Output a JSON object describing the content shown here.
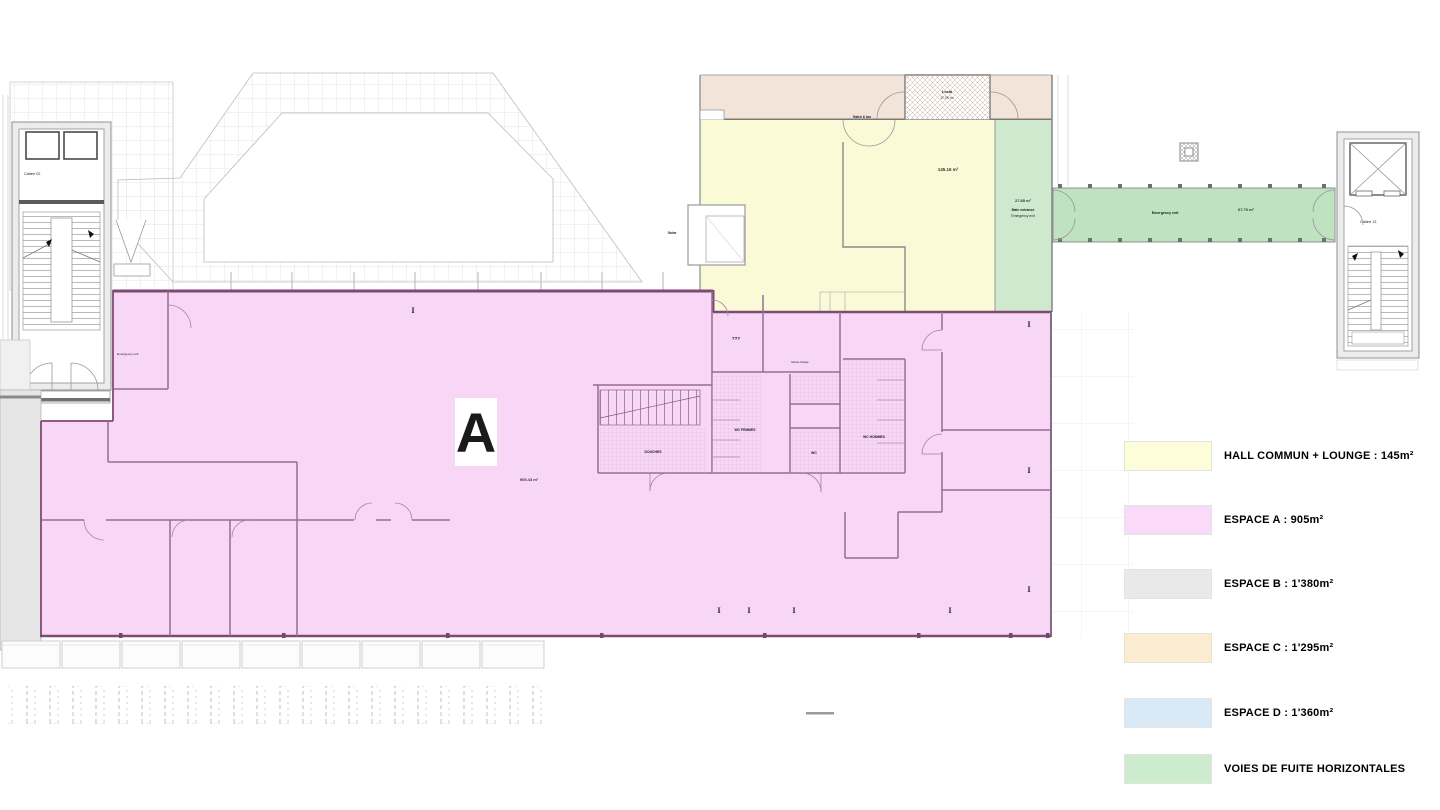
{
  "legend": {
    "items": [
      {
        "label": "HALL COMMUN + LOUNGE : 145m²",
        "color": "#fdfdda"
      },
      {
        "label": "ESPACE A : 905m²",
        "color": "#fbd9f8"
      },
      {
        "label": "ESPACE B : 1'380m²",
        "color": "#e9e9e9"
      },
      {
        "label": "ESPACE C : 1'295m²",
        "color": "#fcecd2"
      },
      {
        "label": "ESPACE D : 1'360m²",
        "color": "#d9eaf6"
      },
      {
        "label": "VOIES DE FUITE HORIZONTALES",
        "color": "#cdeccd"
      }
    ]
  },
  "plan": {
    "espace_a": {
      "big_label": "A",
      "area": "905.43 m²",
      "emergency_exit": "Emergency exit"
    },
    "hall": {
      "area": "145.16 m²",
      "hatch_label": "Hatch & bar"
    },
    "entrance": {
      "area": "27.85 m²",
      "line1": "Main entrance",
      "line2": "Emergency exit"
    },
    "corridor": {
      "label": "Emergency exit",
      "area": "67.70 m²"
    },
    "stair_left": {
      "cabin": "Cabine 02",
      "emergency_exit": "Emergency exit"
    },
    "stair_right": {
      "cabin": "Cabine 13"
    },
    "espace_c": {
      "room_label": "Local",
      "room_area": "17.05 m²"
    },
    "core": {
      "room1": "???",
      "wc_f": "WC FEMMES",
      "wc_h": "WC HOMMES",
      "douches": "DOUCHES",
      "wc": "WC",
      "monte": "Monte-charge",
      "gaine": "Gaine"
    }
  },
  "colors": {
    "espace_a": "#f8d7f6",
    "hall": "#fafad6",
    "espace_c": "#f2e4d8",
    "escape_green": "#cfe9cf",
    "corridor_green": "#bfe3c1",
    "espace_b_gray": "#e6e6e6",
    "wall_maroon": "#7d4a74"
  }
}
